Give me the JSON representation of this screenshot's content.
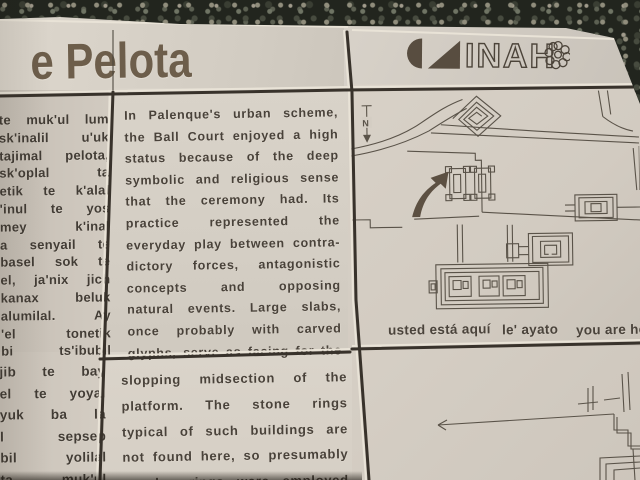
{
  "plaque": {
    "title": "e Pelota",
    "logo": {
      "name": "INAH",
      "letters": "INAH"
    },
    "mayan_panel": {
      "upper_lines": [
        "te muk'ul lum",
        "sk'inalil u'uk",
        "tajimal pelota,",
        "sk'oplal ta",
        "etik te k'alal",
        "'inul te yos",
        "mey k'inal",
        "a senyail te",
        "basel sok te",
        "el, ja'nix jich",
        "kanax beluk",
        "alumilal. Ay",
        "'el tonetik",
        "bi ts'ibubil"
      ],
      "lower_lines": [
        "jib te bay",
        "el te yoyal",
        "yuk ba la",
        "l sepsep",
        "bil yolilal",
        "ta, muk'ul"
      ]
    },
    "english_panel": {
      "upper_lines": [
        "In Palenque's urban scheme,",
        "the Ball Court enjoyed a high",
        "status because of the deep",
        "symbolic and religious sense",
        "that the ceremony had. Its",
        "practice represented the",
        "everyday play between contra-",
        "dictory forces, antagonistic",
        "concepts and opposing",
        "natural events. Large slabs,",
        "once probably with carved",
        "glyphs, serve as facing for the"
      ],
      "lower_lines": [
        "slopping midsection of the",
        "platform. The stone rings",
        "typical of such buildings are",
        "not found here, so presumably",
        "wooden rings were employed"
      ]
    },
    "map_panel": {
      "north_label": "N",
      "captions": {
        "spanish": "usted está aquí",
        "mayan": "le' ayato",
        "english": "you are here"
      }
    },
    "colors": {
      "tile": "#d5cfc5",
      "engraving": "#49423a",
      "title": "#6d5e4b",
      "grout": "#38322b",
      "map_line": "#5a5349",
      "logo_fill": "#584d40",
      "gravel": "#22251e"
    }
  }
}
